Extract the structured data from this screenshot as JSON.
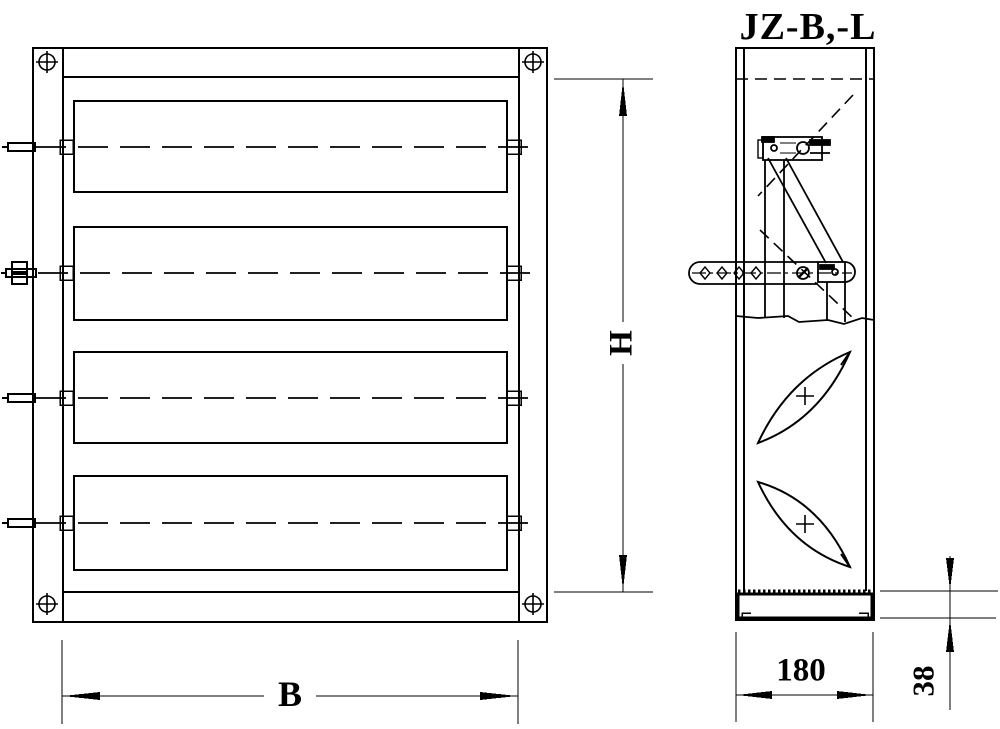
{
  "page": {
    "background": "#ffffff"
  },
  "drawing": {
    "title": "JZ-B,-L",
    "line_color": "#000000",
    "dimensions": {
      "width_label": "B",
      "height_label": "H",
      "depth_label": "180",
      "frame_depth_label": "38"
    }
  }
}
